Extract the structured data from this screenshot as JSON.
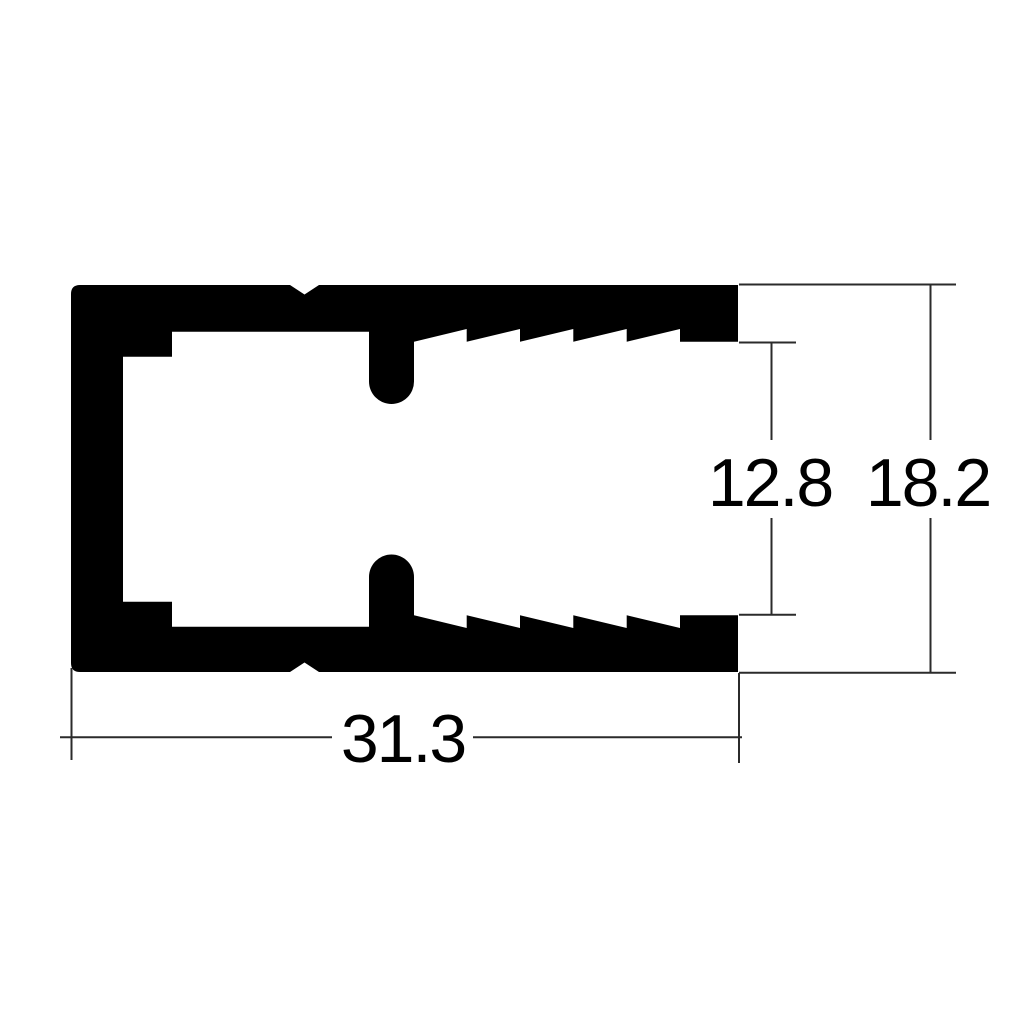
{
  "drawing": {
    "background_color": "#ffffff",
    "profile_color": "#000000",
    "dimension_line_color": "#2b2b2b",
    "label_color": "#000000",
    "dimensions": {
      "overall_width": {
        "label": "31.3",
        "orientation": "horizontal",
        "position": "bottom"
      },
      "slot_height": {
        "label": "12.8",
        "orientation": "vertical",
        "position": "right-inner"
      },
      "overall_height": {
        "label": "18.2",
        "orientation": "vertical",
        "position": "right-outer"
      }
    }
  }
}
